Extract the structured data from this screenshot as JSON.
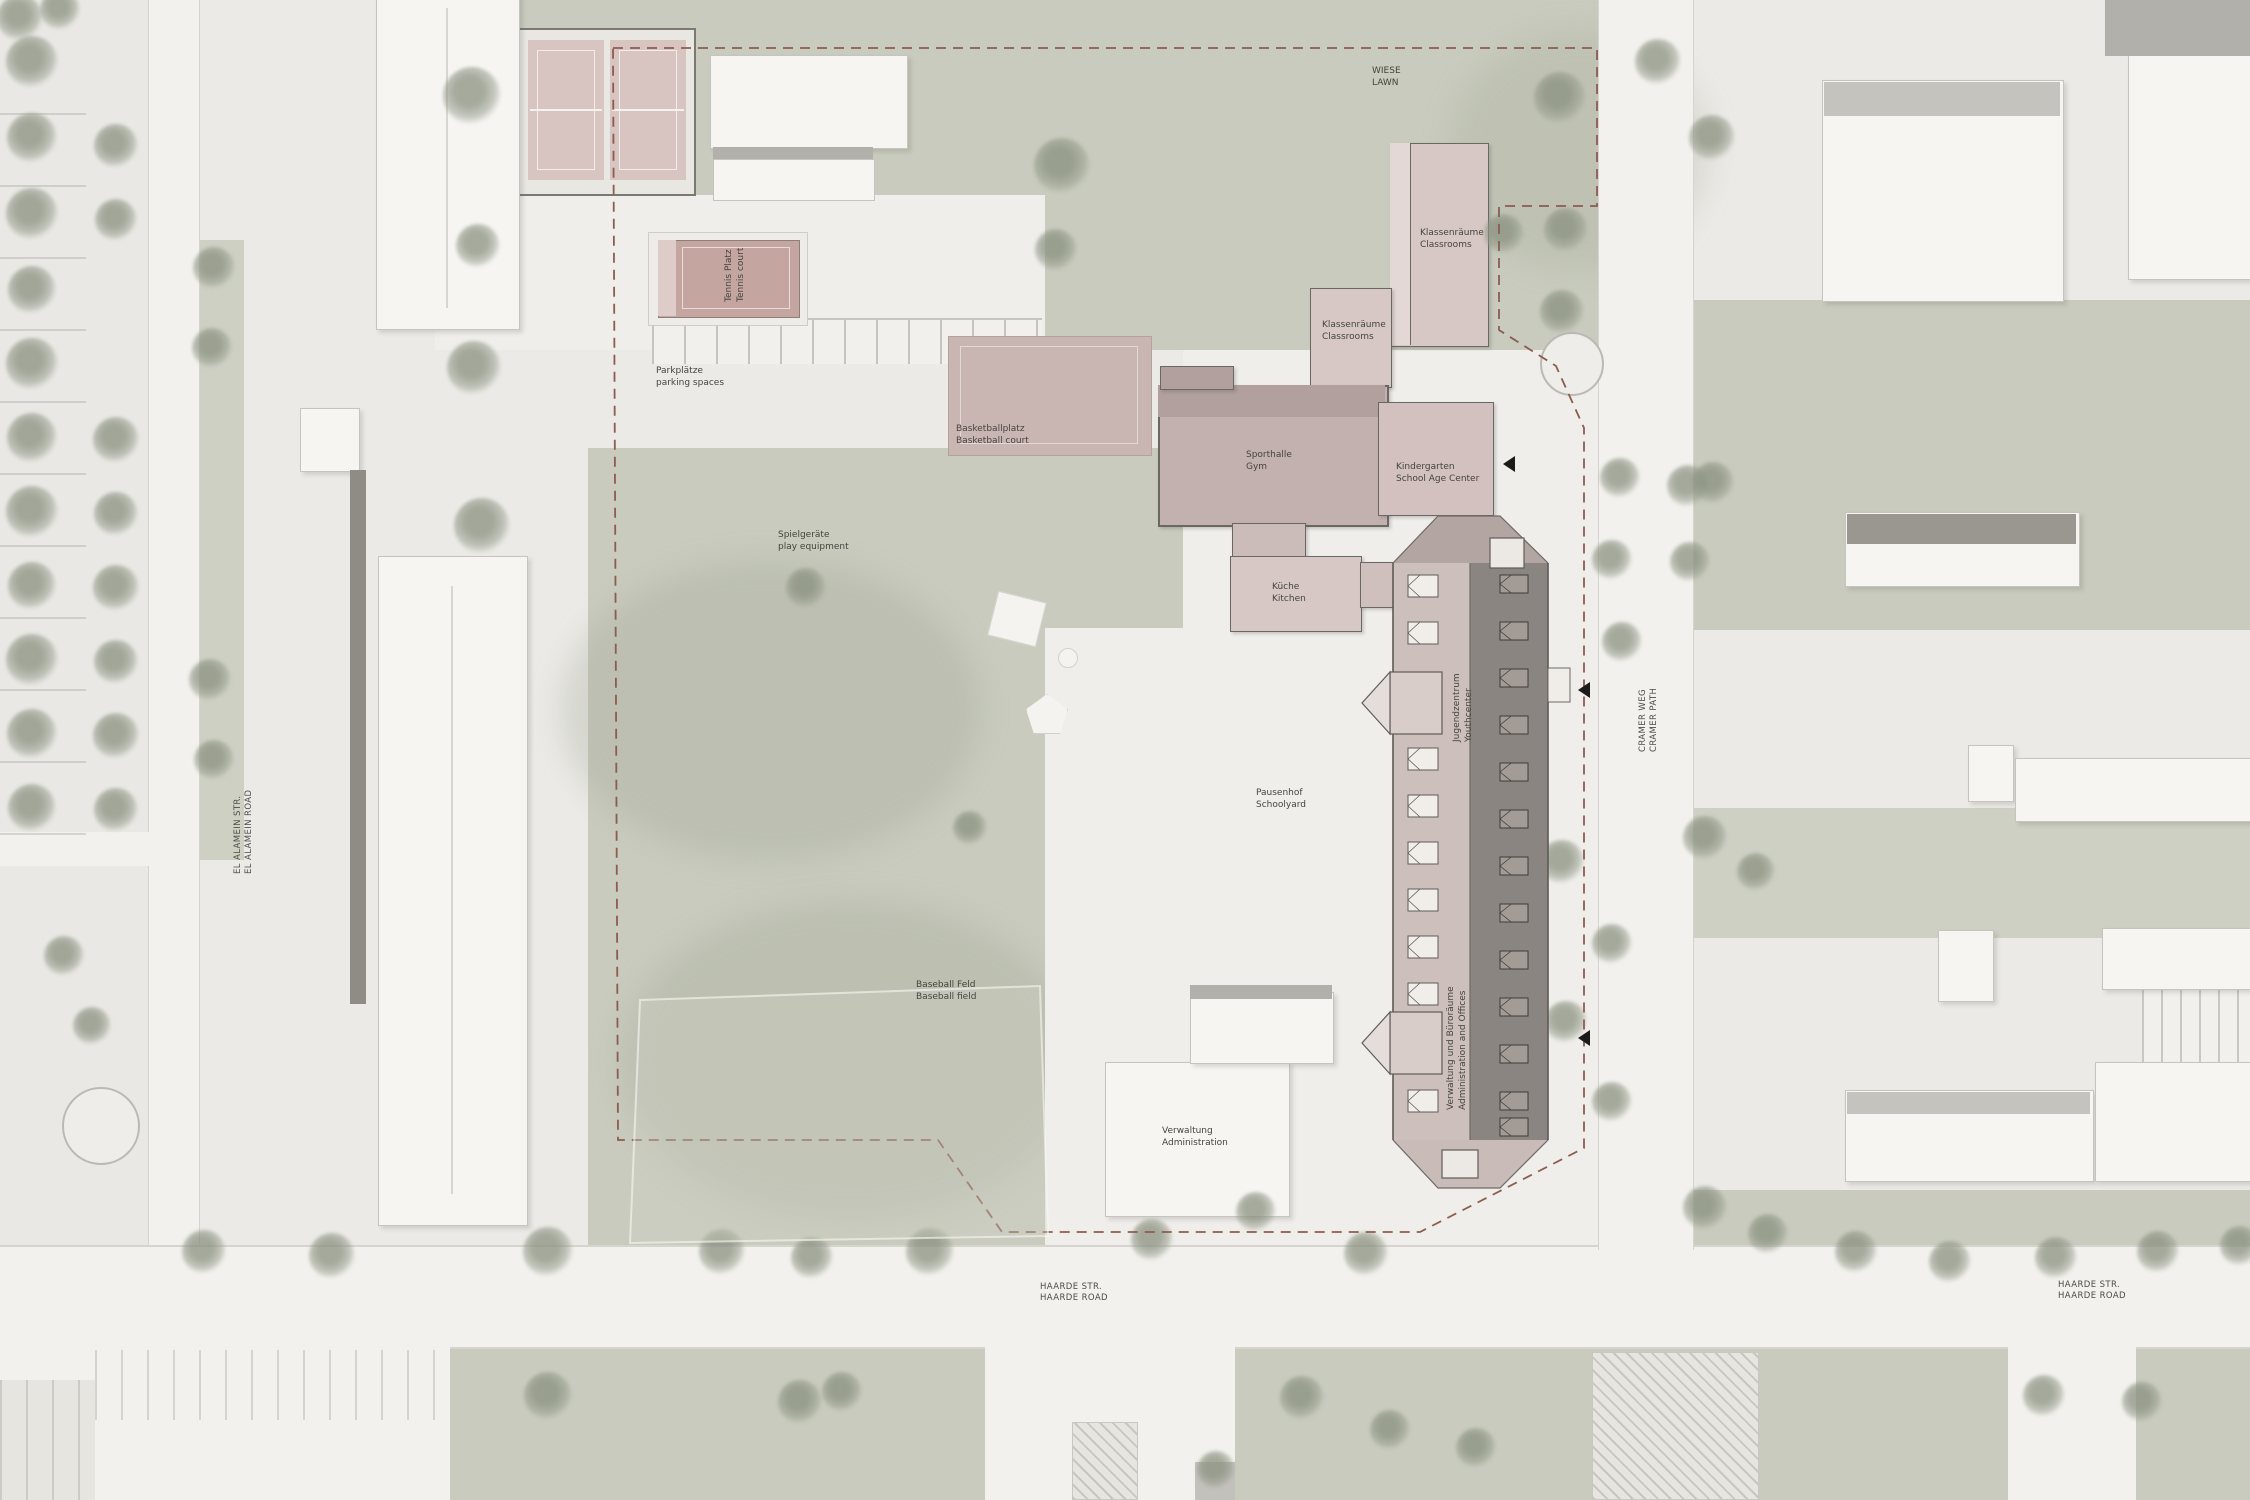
{
  "title": "School campus site plan",
  "labels": {
    "wiese": {
      "de": "WIESE",
      "en": "LAWN"
    },
    "tennis": {
      "de": "Tennis Platz",
      "en": "Tennis court"
    },
    "parkplaetze": {
      "de": "Parkplätze",
      "en": "parking spaces"
    },
    "basketball": {
      "de": "Basketballplatz",
      "en": "Basketball court"
    },
    "sporthalle": {
      "de": "Sporthalle",
      "en": "Gym"
    },
    "klassenraeume": {
      "de": "Klassenräume",
      "en": "Classrooms"
    },
    "kindergarten": {
      "de": "Kindergarten",
      "en": "School Age Center"
    },
    "kueche": {
      "de": "Küche",
      "en": "Kitchen"
    },
    "jugendzentrum": {
      "de": "Jugendzentrum",
      "en": "Youthcenter"
    },
    "verwaltung_buero": {
      "de": "Verwaltung und Büroräume",
      "en": "Administration and Offices"
    },
    "pausenhof": {
      "de": "Pausenhof",
      "en": "Schoolyard"
    },
    "spielgeraete": {
      "de": "Spielgeräte",
      "en": "play equipment"
    },
    "baseball": {
      "de": "Baseball Feld",
      "en": "Baseball field"
    },
    "verwaltung": {
      "de": "Verwaltung",
      "en": "Administration"
    },
    "haarde": {
      "de": "HAARDE STR.",
      "en": "HAARDE ROAD"
    },
    "el_alamein": {
      "de": "EL ALAMEIN STR.",
      "en": "EL ALAMEIN ROAD"
    },
    "cramer": {
      "de": "CRAMER WEG",
      "en": "CRAMER PATH"
    }
  },
  "colors": {
    "background": "#ebeae6",
    "lawn_green": "#c8cbbd",
    "street": "#f2f1ed",
    "building_white": "#f6f5f2",
    "building_pink": "#d7c8c5",
    "gym_mauve": "#c2b1ae",
    "court_red": "#c4a5a0",
    "main_building_dark_roof": "#8a8580",
    "main_building_light_roof": "#cdbfbc",
    "boundary_dashed": "#8d5c50",
    "tree": "#96a08c",
    "label_text": "#45443f"
  }
}
